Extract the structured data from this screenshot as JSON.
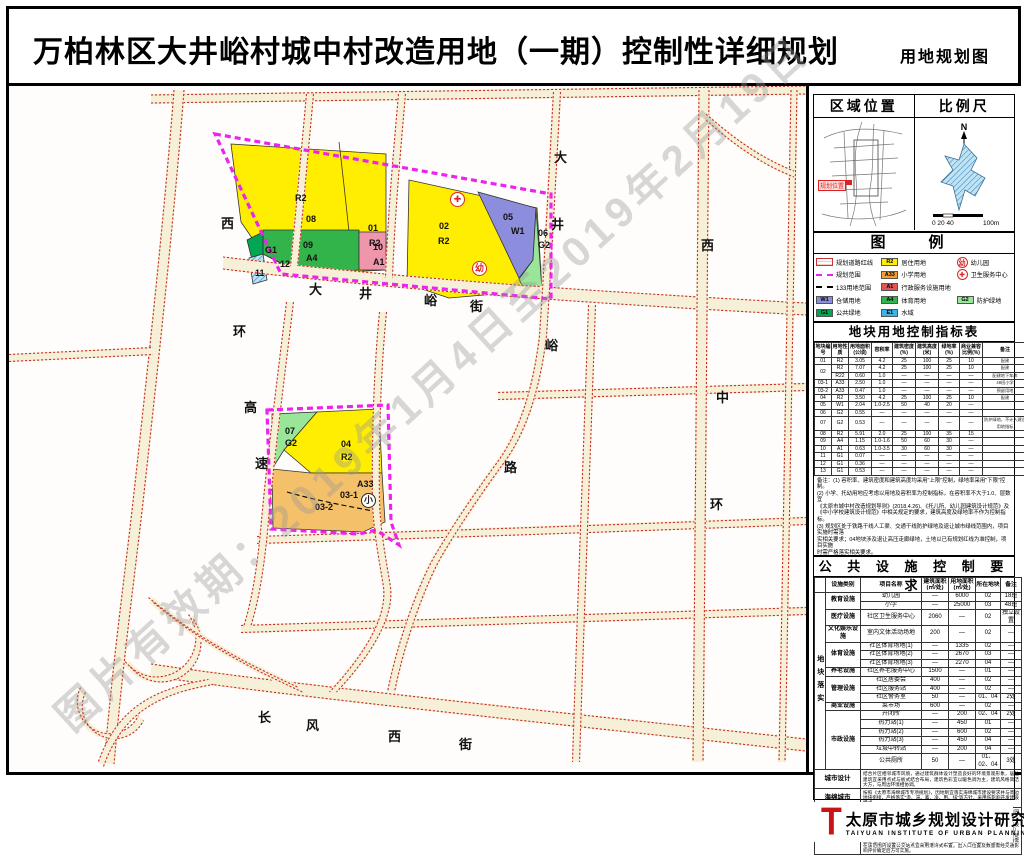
{
  "title": {
    "main": "万柏林区大井峪村城中村改造用地（一期）控制性详细规划",
    "sub": "用地规划图"
  },
  "watermark": "图片有效期：2019年1月4日至2019年2月19日",
  "map": {
    "road_labels": [
      {
        "t": "西",
        "x": 212,
        "y": 204
      },
      {
        "t": "环",
        "x": 224,
        "y": 312
      },
      {
        "t": "高",
        "x": 235,
        "y": 388
      },
      {
        "t": "速",
        "x": 246,
        "y": 444
      },
      {
        "t": "大",
        "x": 300,
        "y": 270
      },
      {
        "t": "井",
        "x": 350,
        "y": 274
      },
      {
        "t": "峪",
        "x": 415,
        "y": 281
      },
      {
        "t": "街",
        "x": 461,
        "y": 287
      },
      {
        "t": "大",
        "x": 545,
        "y": 138
      },
      {
        "t": "井",
        "x": 542,
        "y": 205
      },
      {
        "t": "峪",
        "x": 536,
        "y": 326
      },
      {
        "t": "路",
        "x": 495,
        "y": 448
      },
      {
        "t": "西",
        "x": 692,
        "y": 226
      },
      {
        "t": "中",
        "x": 707,
        "y": 378
      },
      {
        "t": "环",
        "x": 701,
        "y": 485
      },
      {
        "t": "长",
        "x": 249,
        "y": 698
      },
      {
        "t": "风",
        "x": 297,
        "y": 706
      },
      {
        "t": "西",
        "x": 379,
        "y": 717
      },
      {
        "t": "街",
        "x": 450,
        "y": 725
      }
    ],
    "parcel_labels": [
      {
        "t": "R2",
        "x": 286,
        "y": 184
      },
      {
        "t": "08",
        "x": 297,
        "y": 205
      },
      {
        "t": "01",
        "x": 359,
        "y": 214
      },
      {
        "t": "R2",
        "x": 360,
        "y": 229
      },
      {
        "t": "09",
        "x": 294,
        "y": 231
      },
      {
        "t": "A4",
        "x": 297,
        "y": 244
      },
      {
        "t": "10",
        "x": 364,
        "y": 233
      },
      {
        "t": "A1",
        "x": 364,
        "y": 248
      },
      {
        "t": "G1",
        "x": 256,
        "y": 236
      },
      {
        "t": "12",
        "x": 271,
        "y": 250
      },
      {
        "t": "11",
        "x": 246,
        "y": 259
      },
      {
        "t": "02",
        "x": 430,
        "y": 212
      },
      {
        "t": "R2",
        "x": 429,
        "y": 227
      },
      {
        "t": "05",
        "x": 494,
        "y": 203
      },
      {
        "t": "W1",
        "x": 502,
        "y": 217
      },
      {
        "t": "06",
        "x": 529,
        "y": 219
      },
      {
        "t": "G2",
        "x": 529,
        "y": 231
      },
      {
        "t": "07",
        "x": 276,
        "y": 417
      },
      {
        "t": "G2",
        "x": 276,
        "y": 429
      },
      {
        "t": "04",
        "x": 332,
        "y": 430
      },
      {
        "t": "R2",
        "x": 332,
        "y": 443
      },
      {
        "t": "A33",
        "x": 348,
        "y": 470
      },
      {
        "t": "03-1",
        "x": 331,
        "y": 481
      },
      {
        "t": "03-2",
        "x": 306,
        "y": 493
      }
    ],
    "icons": [
      {
        "type": "cross",
        "t": "✚",
        "x": 441,
        "y": 183
      },
      {
        "type": "kindergarten",
        "t": "幼",
        "x": 463,
        "y": 252
      },
      {
        "type": "school",
        "t": "小",
        "x": 352,
        "y": 484
      }
    ]
  },
  "sidebar": {
    "location": {
      "title": "区域位置",
      "marker": "规划位置"
    },
    "scale": {
      "title": "比例尺",
      "north": "N",
      "ticks": "0 20 40",
      "end": "100m"
    },
    "legend": {
      "title": "图　例",
      "cols": [
        [
          {
            "type": "hatch",
            "label": "规划道路红线"
          },
          {
            "type": "dash-magenta",
            "label": "规划范围"
          },
          {
            "type": "dash-black",
            "label": "133用地范围"
          },
          {
            "type": "box",
            "color": "#8d8ddd",
            "code": "W1",
            "label": "仓储用地"
          },
          {
            "type": "box",
            "color": "#00a651",
            "code": "G1",
            "label": "公共绿地"
          }
        ],
        [
          {
            "type": "box",
            "color": "#ffee00",
            "code": "R2",
            "label": "居住用地"
          },
          {
            "type": "box",
            "color": "#f0a030",
            "code": "A33",
            "label": "小学用地"
          },
          {
            "type": "box",
            "color": "#e05555",
            "code": "A1",
            "label": "行政服务设施用地"
          },
          {
            "type": "box",
            "color": "#33b44a",
            "code": "A4",
            "label": "体育用地"
          },
          {
            "type": "box",
            "color": "#3bb4e8",
            "code": "E1",
            "label": "水域"
          }
        ],
        [
          {
            "type": "icon-kind",
            "label": "幼儿园"
          },
          {
            "type": "icon-cross",
            "label": "卫生服务中心"
          },
          {
            "type": "none",
            "label": ""
          },
          {
            "type": "box",
            "color": "#99e699",
            "code": "G2",
            "label": "防护绿地"
          },
          {
            "type": "none",
            "label": ""
          }
        ]
      ]
    },
    "index_table": {
      "title": "地块用地控制指标表",
      "headers": [
        "地块编号",
        "用地性质",
        "用地面积(公顷)",
        "容积率",
        "建筑密度(%)",
        "建筑高度(米)",
        "绿地率(%)",
        "商业兼容比例(%)",
        "备注"
      ],
      "rows": [
        [
          "01",
          "R2",
          "3.05",
          "4.2",
          "25",
          "100",
          "25",
          "10",
          "配建"
        ],
        [
          "02",
          "R2",
          "7.07",
          "4.2",
          "25",
          "100",
          "25",
          "10",
          "配建"
        ],
        [
          "",
          "R22",
          "0.60",
          "1.0",
          "—",
          "—",
          "—",
          "—",
          "配建地下车库"
        ],
        [
          "03-1",
          "A33",
          "2.50",
          "1.0",
          "—",
          "—",
          "—",
          "—",
          "48班小学"
        ],
        [
          "03-2",
          "A33",
          "0.47",
          "1.0",
          "—",
          "—",
          "—",
          "—",
          "预留用地"
        ],
        [
          "04",
          "R2",
          "3.50",
          "4.2",
          "25",
          "100",
          "25",
          "10",
          "配建"
        ],
        [
          "05",
          "W1",
          "2.04",
          "1.0-2.5",
          "50",
          "40",
          "20",
          "—",
          ""
        ],
        [
          "06",
          "G2",
          "0.55",
          "—",
          "—",
          "—",
          "—",
          "—",
          ""
        ],
        [
          "07",
          "G2",
          "0.53",
          "—",
          "—",
          "—",
          "—",
          "—",
          "防护绿地，不计入建设用地指标"
        ],
        [
          "08",
          "R2",
          "5.91",
          "2.0",
          "25",
          "100",
          "35",
          "15",
          ""
        ],
        [
          "09",
          "A4",
          "1.15",
          "1.0-1.6",
          "50",
          "60",
          "30",
          "—",
          ""
        ],
        [
          "10",
          "A1",
          "0.63",
          "1.0-3.5",
          "30",
          "60",
          "30",
          "—",
          ""
        ],
        [
          "11",
          "G1",
          "0.07",
          "—",
          "—",
          "—",
          "—",
          "—",
          ""
        ],
        [
          "12",
          "G1",
          "0.36",
          "—",
          "—",
          "—",
          "—",
          "—",
          ""
        ],
        [
          "13",
          "G1",
          "0.53",
          "—",
          "—",
          "—",
          "—",
          "—",
          ""
        ]
      ],
      "notes": [
        "备注：(1) 容积率、建筑密度和建筑高度均采用\"上限\"控制，绿地率采用\"下限\"控制。",
        "(2) 小学、托幼用地应考虑以用地及容积率为控制指标，在容积率不大于1.0、层数宜",
        "《太原市城中村改造规划导则》(2018.4.26)、《托儿所、幼儿园建筑设计规范》及",
        "《中小学校建筑设计规范》中相关规定的要求，建筑高度及绿地率不作为控制指标。",
        "(3) 规划区处于铁路干线人工渠、交通干线防护绿地及退让城市绿线范围内，项目实施时需落",
        "实相关要求；04地块涉及退让高压走廊绿地，土地以已有规划红线为准控制，项目实施",
        "时需严格落实相关要求。"
      ]
    },
    "facility_table": {
      "title": "公 共 设 施 控 制 要 求",
      "side_label": "地块落实",
      "headers": [
        "设施类别",
        "项目名称",
        "建筑面积(㎡/处)",
        "用地面积(㎡/处)",
        "所在地块",
        "备注"
      ],
      "rows": [
        {
          "cat": "教育设施",
          "span": 2,
          "name": "幼儿园",
          "b": "—",
          "l": "6000",
          "blk": "02",
          "note": "18班"
        },
        {
          "name": "小学",
          "b": "—",
          "l": "25000",
          "blk": "03",
          "note": "48班"
        },
        {
          "cat": "医疗设施",
          "span": 1,
          "name": "社区卫生服务中心",
          "b": "2060",
          "l": "—",
          "blk": "02",
          "note": "独立设置"
        },
        {
          "cat": "文化娱乐设施",
          "span": 1,
          "name": "室内文体活动场地",
          "b": "200",
          "l": "—",
          "blk": "02",
          "note": "—"
        },
        {
          "cat": "体育设施",
          "span": 3,
          "name": "社区体育场地(1)",
          "b": "—",
          "l": "1335",
          "blk": "02",
          "note": "—"
        },
        {
          "name": "社区体育场地(2)",
          "b": "—",
          "l": "2670",
          "blk": "03",
          "note": "—"
        },
        {
          "name": "社区体育场地(3)",
          "b": "—",
          "l": "2270",
          "blk": "04",
          "note": "—"
        },
        {
          "cat": "养老设施",
          "span": 1,
          "name": "社区养老服务中心",
          "b": "1500",
          "l": "—",
          "blk": "01",
          "note": "—"
        },
        {
          "cat": "管理设施",
          "span": 3,
          "name": "社区居委会",
          "b": "400",
          "l": "—",
          "blk": "02",
          "note": "—"
        },
        {
          "name": "社区服务站",
          "b": "400",
          "l": "—",
          "blk": "02",
          "note": "—"
        },
        {
          "name": "社区警务室",
          "b": "50",
          "l": "—",
          "blk": "01、04",
          "note": "2处"
        },
        {
          "cat": "商业设施",
          "span": 1,
          "name": "菜市场",
          "b": "600",
          "l": "—",
          "blk": "02",
          "note": "—"
        },
        {
          "cat": "市政设施",
          "span": 6,
          "name": "开闭所",
          "b": "—",
          "l": "200",
          "blk": "02、04",
          "note": "2处"
        },
        {
          "name": "热力站(1)",
          "b": "—",
          "l": "450",
          "blk": "01",
          "note": "—"
        },
        {
          "name": "热力站(2)",
          "b": "—",
          "l": "600",
          "blk": "02",
          "note": "—"
        },
        {
          "name": "热力站(3)",
          "b": "—",
          "l": "450",
          "blk": "04",
          "note": "—"
        },
        {
          "name": "垃圾中转站",
          "b": "—",
          "l": "200",
          "blk": "04",
          "note": "—"
        },
        {
          "name": "公共厕所",
          "b": "50",
          "l": "—",
          "blk": "01、02、04",
          "note": "3处"
        }
      ],
      "extra_rows": [
        {
          "label": "城市设计",
          "text": "结合片区相邻城市风貌，通过建筑群体设计塑造良好的环境景观形象，居住建筑宜采用点式与板式结合布局，建筑色彩宜以暖色调为主，建筑风格简洁大方，与周边环境相协调。"
        },
        {
          "label": "海绵城市",
          "text": "按照《太原市海绵城市专项规划》，因地制宜落实海绵城市建设要求并与周边地块衔接，严格落实\"渗、滞、蓄、净、用、排\"等方针，采用低影响开发建设模式。"
        },
        {
          "label": "产业引导",
          "text": "现代服务业聚集区，依托周边优势资源发展现代综合服务业或文化创意园区。"
        },
        {
          "label": "出入口控制",
          "text": "规划用地与城市主干道交叉口处的机动车出入口距离不宜小于70米且不应设置在主干道上；人行出入口宜与人行过街设施（包括天桥、地道、斑马线）结合设置便于公共交通换乘；居住区出入口、公共建筑出入口与道路衔接处应合理组织交通流线；机动车出入口200米范围内不宜设置公交站点，若确需在该范围内设置公交站点宜采用港湾式布置。出入口位置及数量需经交通影响评价确定后方可实施。"
        }
      ]
    },
    "institute": {
      "logo": "T",
      "name": "太原市城乡规划设计研究院",
      "en": "TAIYUAN INSTITUTE OF URBAN PLANNING AND DESIGN"
    }
  }
}
